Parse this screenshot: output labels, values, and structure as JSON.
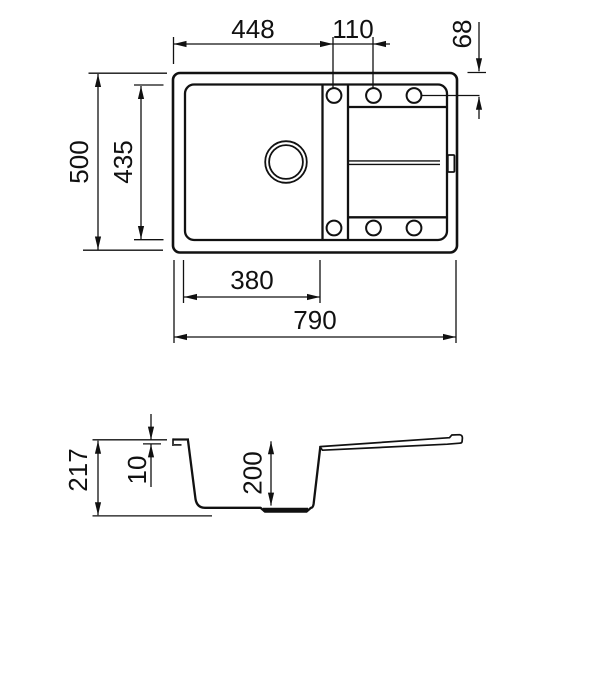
{
  "drawing": {
    "kind": "sink-technical-drawing",
    "line_color": "#111111",
    "background_color": "#ffffff"
  },
  "top_view": {
    "label_448": "448",
    "label_110": "110",
    "label_68": "68",
    "label_500": "500",
    "label_435": "435",
    "label_380": "380",
    "label_790": "790"
  },
  "side_view": {
    "label_217": "217",
    "label_10": "10",
    "label_200": "200"
  }
}
